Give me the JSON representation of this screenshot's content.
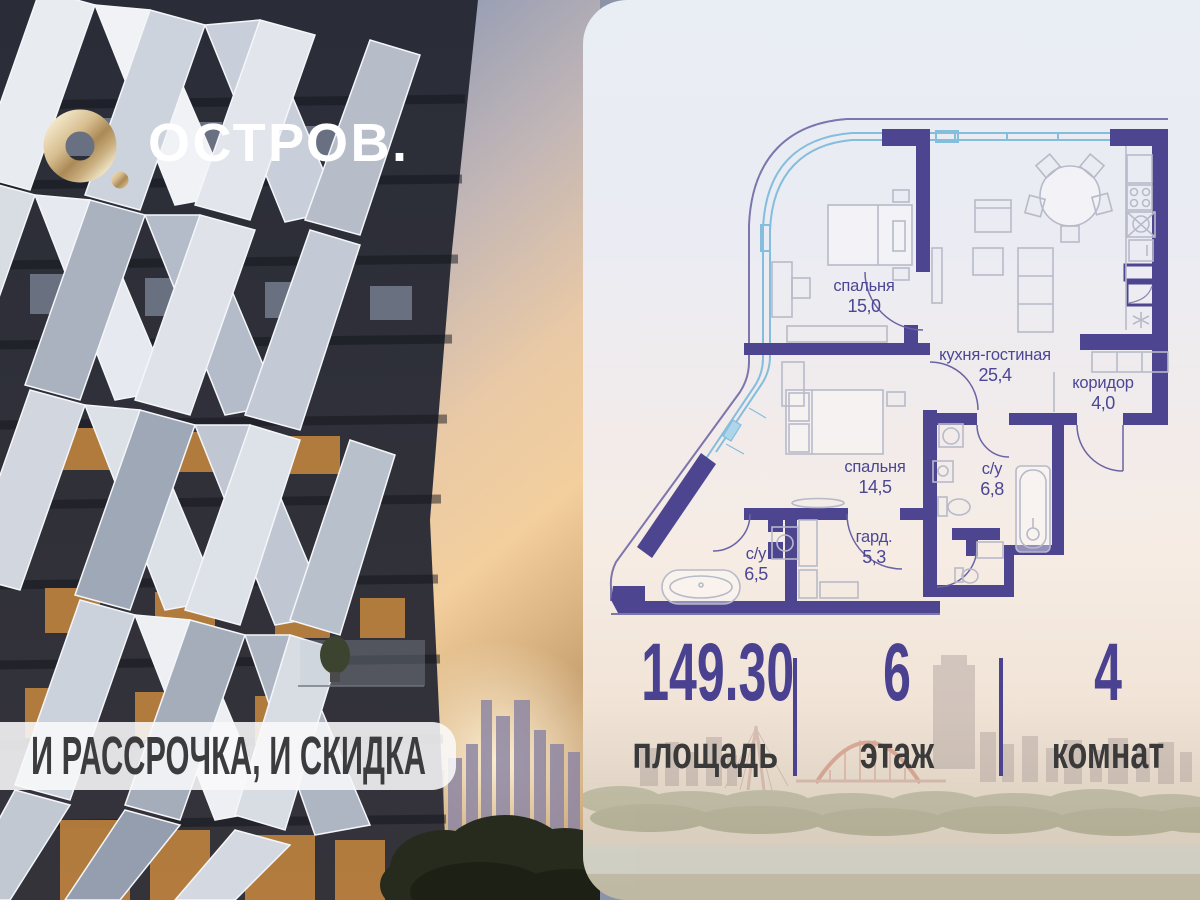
{
  "brand": {
    "name": "ОСТРОВ."
  },
  "banner": {
    "text": "И РАССРОЧКА, И СКИДКА"
  },
  "floorplan": {
    "rooms": [
      {
        "name": "спальня",
        "area": "15,0"
      },
      {
        "name": "кухня-гостиная",
        "area": "25,4"
      },
      {
        "name": "коридор",
        "area": "4,0"
      },
      {
        "name": "спальня",
        "area": "14,5"
      },
      {
        "name": "с/у",
        "area": "6,8"
      },
      {
        "name": "гард.",
        "area": "5,3"
      },
      {
        "name": "с/у",
        "area": "6,5"
      }
    ]
  },
  "stats": [
    {
      "value": "149.30",
      "label": "площадь"
    },
    {
      "value": "6",
      "label": "этаж"
    },
    {
      "value": "4",
      "label": "комнат"
    }
  ],
  "colors": {
    "wall": "#4e4591",
    "window_line": "#85bddc",
    "room_label": "#4c4794",
    "stat_value": "#4a4190",
    "stat_label": "#3a3a3a",
    "logo_gold": "#cbb07e",
    "banner_bg": "#f7f7f9",
    "banner_text": "#3c3c3e"
  }
}
